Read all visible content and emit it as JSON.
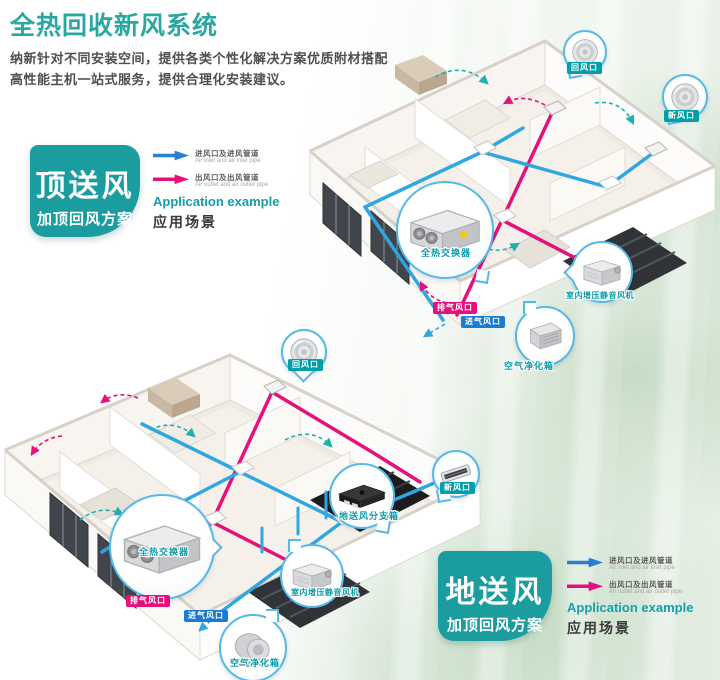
{
  "header": {
    "title": "全热回收新风系统",
    "subtitle_line1": "纳新针对不同安装空间，提供各类个性化解决方案优质附材搭配",
    "subtitle_line2": "高性能主机一站式服务，提供合理化安装建议。"
  },
  "legend": {
    "inlet_cn": "进风口及进风管道",
    "inlet_en": "Air inlet and air inlet pipe",
    "outlet_cn": "出风口及出风管道",
    "outlet_en": "Air outlet and air outlet pipe"
  },
  "scheme_top": {
    "badge_title": "顶送风",
    "badge_subtitle": "加顶回风方案",
    "application_en": "Application example",
    "application_cn": "应用场景"
  },
  "scheme_bottom": {
    "badge_title": "地送风",
    "badge_subtitle": "加顶回风方案",
    "application_en": "Application example",
    "application_cn": "应用场景"
  },
  "house_top": {
    "labels": {
      "return_vent": "回风口",
      "fresh_vent": "新风口",
      "heat_exchanger": "全热交换器",
      "booster_fan": "室内增压静音风机",
      "exhaust_vent": "排气风口",
      "intake_vent": "进气风口",
      "air_purifier": "空气净化箱"
    }
  },
  "house_bottom": {
    "labels": {
      "return_vent": "回风口",
      "fresh_vent": "新风口",
      "distribution_box": "地送风分支箱",
      "heat_exchanger": "全热交换器",
      "booster_fan": "室内增压静音风机",
      "exhaust_vent": "排气风口",
      "intake_vent": "进气风口",
      "air_purifier": "空气净化箱"
    }
  },
  "colors": {
    "accent_teal": "#1B9DA0",
    "title_teal": "#2AA7A1",
    "pipe_blue": "#2FA7E0",
    "pipe_pink": "#E6107C",
    "legend_blue": "#2A7ED4",
    "callout_border_blue": "#55B9E7"
  }
}
